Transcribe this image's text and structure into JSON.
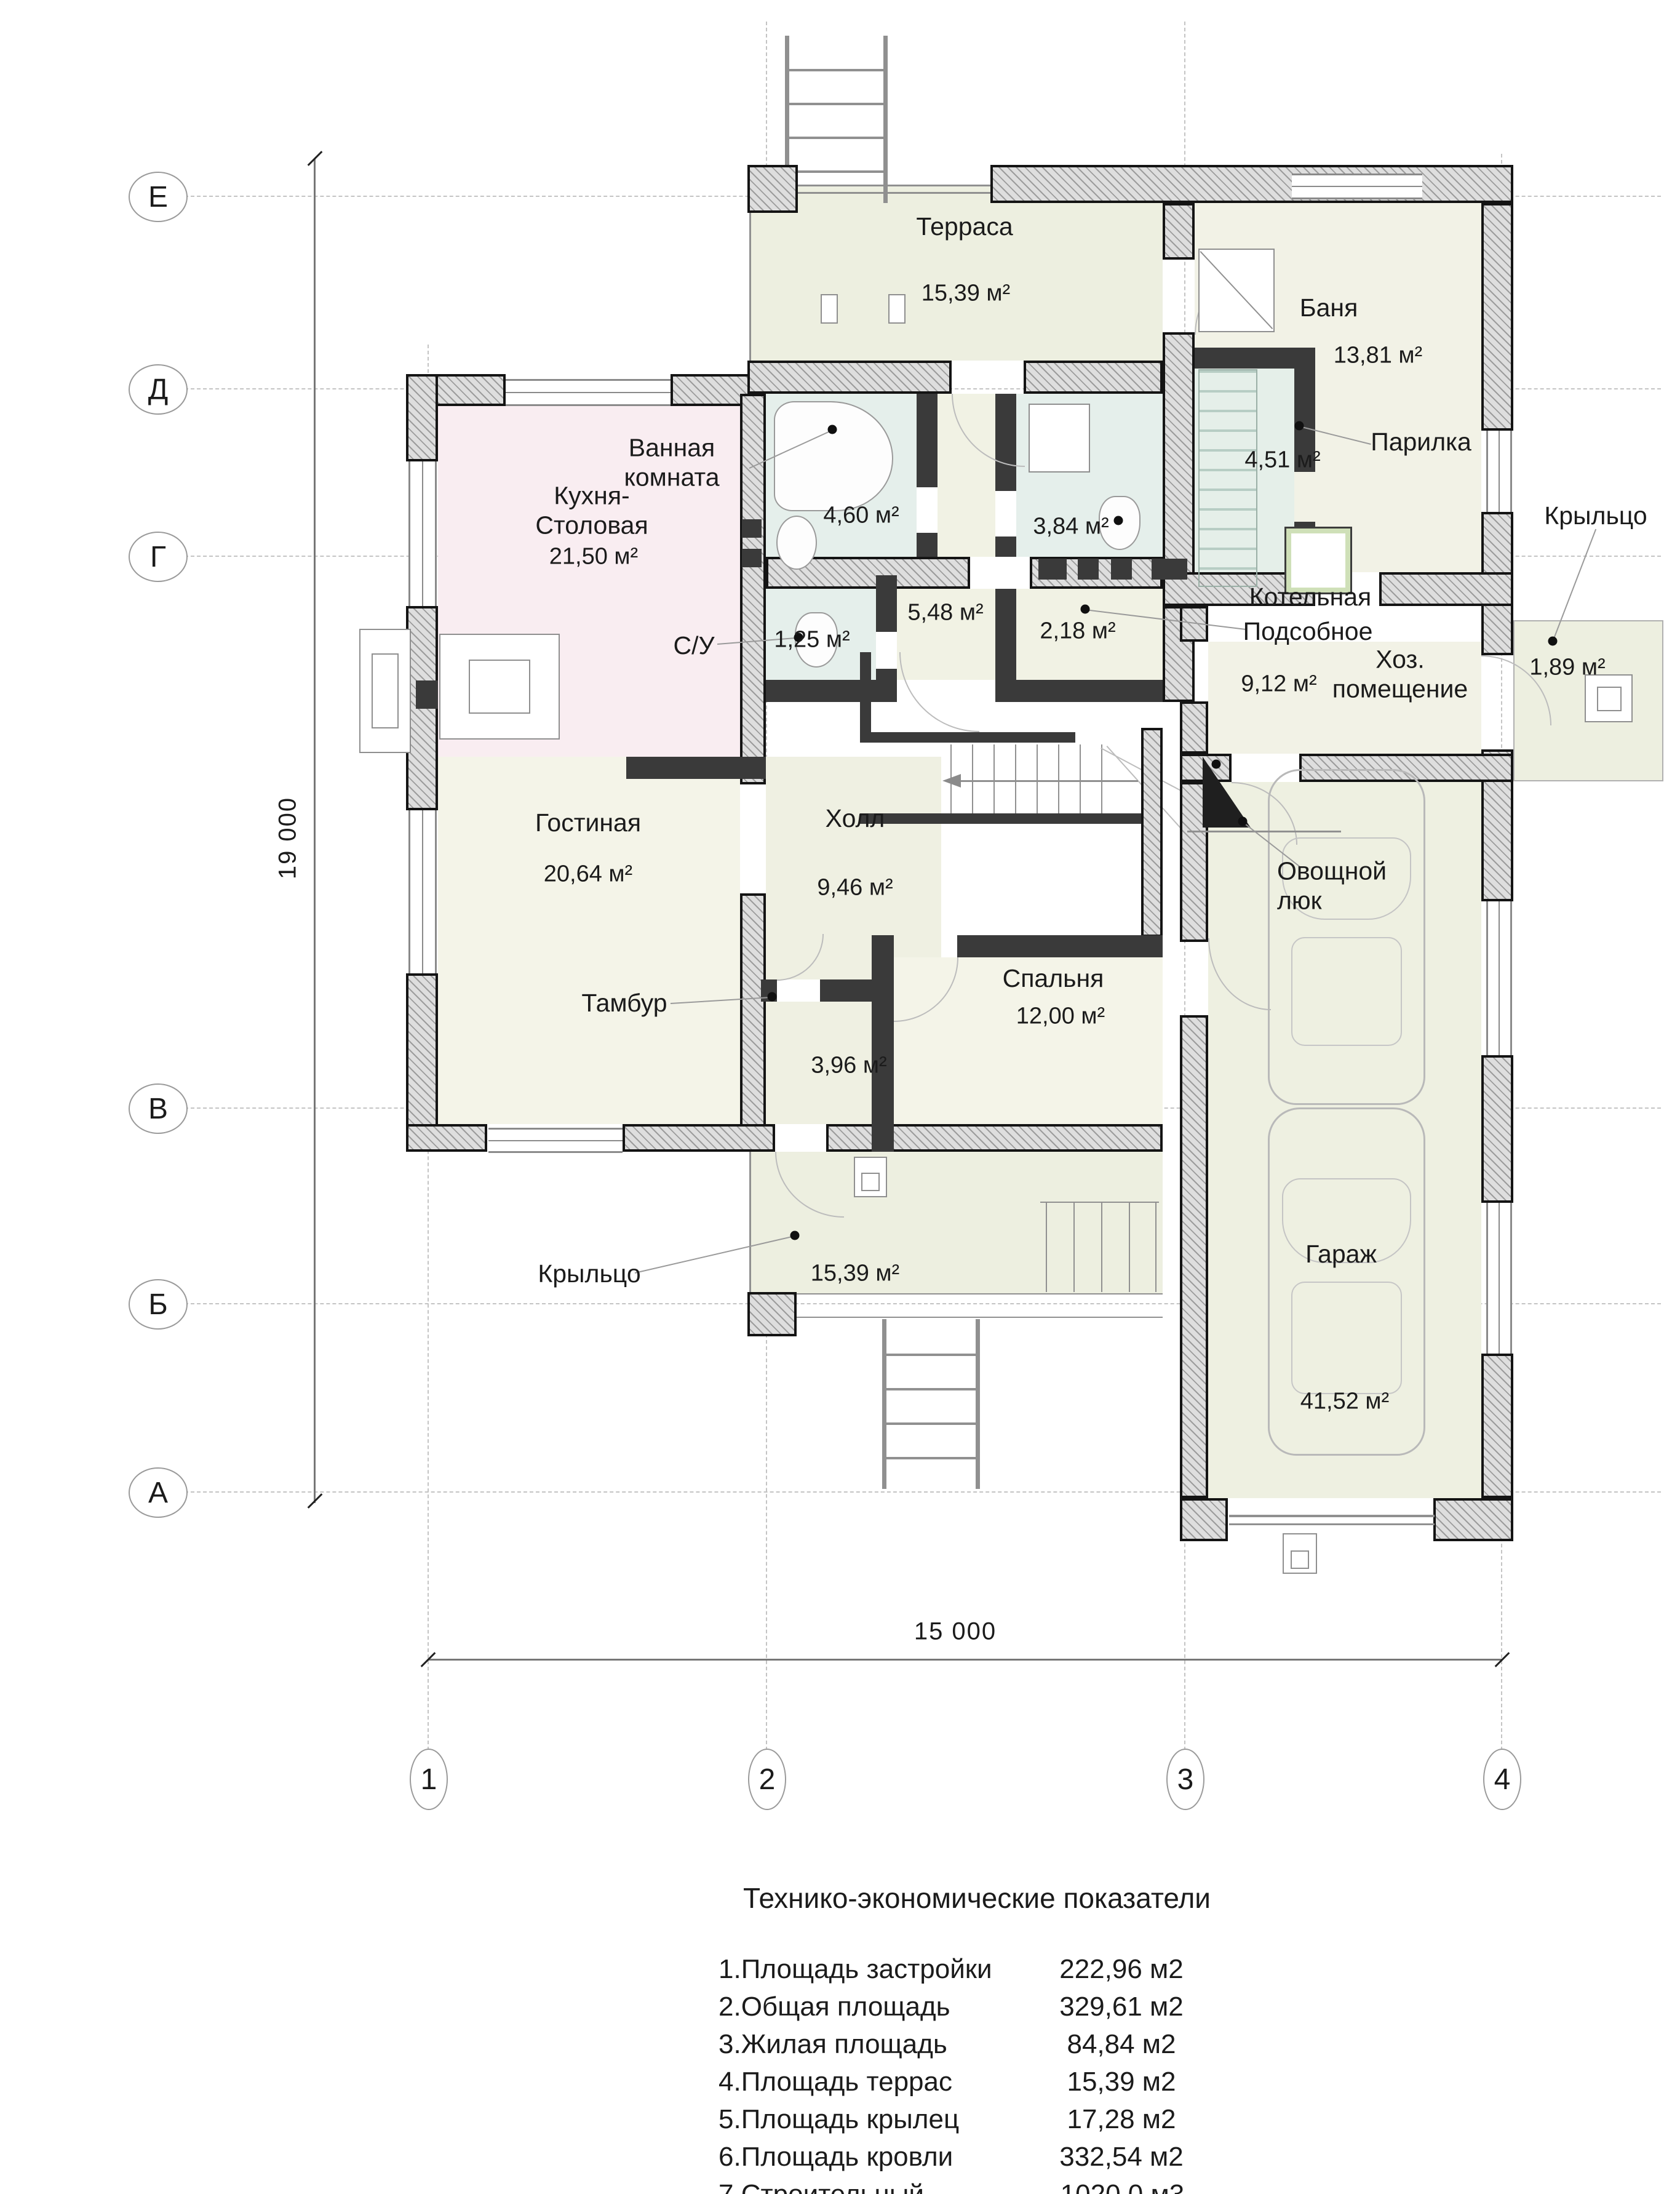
{
  "axes": {
    "rows": [
      "Е",
      "Д",
      "Г",
      "В",
      "Б",
      "А"
    ],
    "cols": [
      "1",
      "2",
      "3",
      "4"
    ]
  },
  "dimensions": {
    "height_total": "19 000",
    "width_total": "15 000"
  },
  "rooms": {
    "terrace": {
      "name": "Терраса",
      "area": "15,39 м²"
    },
    "bania": {
      "name": "Баня",
      "area": "13,81 м²"
    },
    "parilka": {
      "name": "Парилка",
      "area": "4,51 м²"
    },
    "porch_right": {
      "name": "Крыльцо",
      "area": "1,89 м²"
    },
    "bathroom": {
      "name": "Ванная\nкомната",
      "area": "4,60 м²"
    },
    "bathroom2": {
      "area": "3,84 м²"
    },
    "kitchen": {
      "name": "Кухня-\nСтоловая",
      "area": "21,50 м²"
    },
    "wc": {
      "name": "С/У",
      "area": "1,25 м²"
    },
    "corridor": {
      "area": "5,48 м²"
    },
    "lobby": {
      "area": "2,18 м²"
    },
    "boiler": {
      "name1": "Котельная",
      "name2": "Подсобное",
      "name3": "Хоз.\nпомещение",
      "area": "9,12 м²"
    },
    "living": {
      "name": "Гостиная",
      "area": "20,64 м²"
    },
    "hall": {
      "name": "Холл",
      "area": "9,46 м²"
    },
    "bedroom": {
      "name": "Спальня",
      "area": "12,00 м²"
    },
    "tambour": {
      "name": "Тамбур",
      "area": "3,96 м²"
    },
    "porch_main": {
      "name": "Крыльцо",
      "area": "15,39 м²"
    },
    "garage": {
      "name": "Гараж",
      "area": "41,52 м²"
    },
    "veg": {
      "name": "Овощной\nлюк"
    }
  },
  "summary": {
    "title": "Технико-экономические показатели",
    "rows": [
      {
        "label": "1.Площадь застройки",
        "value": "222,96 м2"
      },
      {
        "label": "2.Общая площадь",
        "value": "329,61 м2"
      },
      {
        "label": "3.Жилая площадь",
        "value": "84,84 м2"
      },
      {
        "label": "4.Площадь террас",
        "value": "15,39 м2"
      },
      {
        "label": "5.Площадь крылец",
        "value": "17,28 м2"
      },
      {
        "label": "6.Площадь кровли",
        "value": "332,54 м2"
      },
      {
        "label": "7.Строительный объём",
        "value": "1020,0 м3"
      }
    ]
  }
}
